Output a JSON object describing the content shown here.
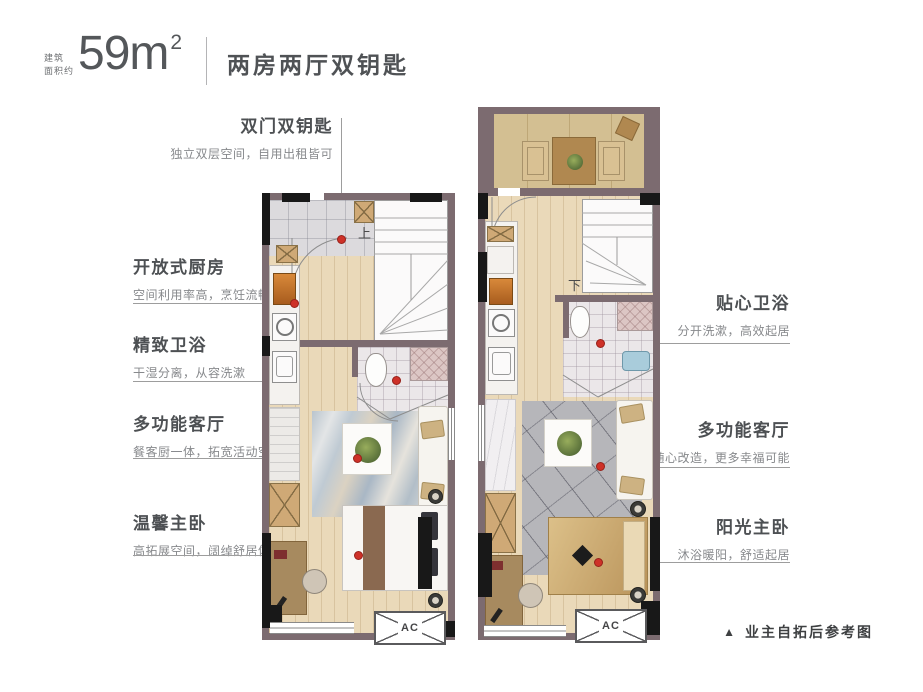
{
  "header": {
    "area_note_line1": "建筑",
    "area_note_line2": "面积约",
    "area_value": "59m",
    "area_sup": "2",
    "title": "两房两厅双钥匙"
  },
  "callouts": {
    "left": [
      {
        "title": "双门双钥匙",
        "subtitle": "独立双层空间，自用出租皆可"
      },
      {
        "title": "开放式厨房",
        "subtitle": "空间利用率高，烹饪流畅便捷"
      },
      {
        "title": "精致卫浴",
        "subtitle": "干湿分离，从容洗漱"
      },
      {
        "title": "多功能客厅",
        "subtitle": "餐客厨一体，拓宽活动空间"
      },
      {
        "title": "温馨主卧",
        "subtitle": "高拓展空间，阔绰舒居体验"
      }
    ],
    "right": [
      {
        "title": "贴心卫浴",
        "subtitle": "分开洗漱，高效起居"
      },
      {
        "title": "多功能客厅",
        "subtitle": "随心改造，更多幸福可能"
      },
      {
        "title": "阳光主卧",
        "subtitle": "沐浴暖阳，舒适起居"
      }
    ]
  },
  "plans": {
    "lower": {
      "stair_label": "上",
      "ac_label": "AC"
    },
    "upper": {
      "stair_label": "下",
      "ac_label": "AC"
    }
  },
  "footer": {
    "marker": "▲",
    "note": "业主自拓后参考图"
  },
  "colors": {
    "wall": "#7c6b70",
    "column": "#181818",
    "accent_red": "#ce3128",
    "wood": "#ead9b9",
    "terrace": "#d3bf92"
  }
}
